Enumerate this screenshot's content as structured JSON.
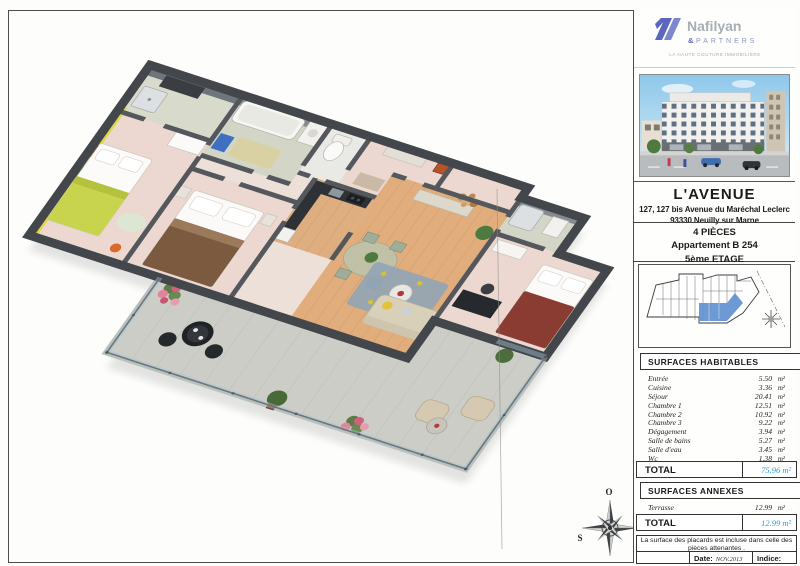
{
  "logo": {
    "brand": "Nafilyan",
    "amp": "&",
    "partners": "PARTNERS",
    "tagline": "LA HAUTE COUTURE IMMOBILIÈRE",
    "accent": "#5a66c0"
  },
  "project": {
    "title": "L'AVENUE",
    "address_line1": "127, 127 bis Avenue du Maréchal Leclerc",
    "address_line2": "93330 Neuilly sur Marne"
  },
  "unit": {
    "rooms_count": "4 PIÈCES",
    "apartment": "Appartement B 254",
    "floor": "5ème ETAGE"
  },
  "surfaces": {
    "habitables_title": "SURFACES  HABITABLES",
    "rows": [
      {
        "label": "Entrée",
        "value": "5.50",
        "unit": "m²"
      },
      {
        "label": "Cuisine",
        "value": "3.36",
        "unit": "m²"
      },
      {
        "label": "Séjour",
        "value": "20.41",
        "unit": "m²"
      },
      {
        "label": "Chambre 1",
        "value": "12.51",
        "unit": "m²"
      },
      {
        "label": "Chambre 2",
        "value": "10.92",
        "unit": "m²"
      },
      {
        "label": "Chambre 3",
        "value": "9.22",
        "unit": "m²"
      },
      {
        "label": "Dégagement",
        "value": "3.94",
        "unit": "m²"
      },
      {
        "label": "Salle de bains",
        "value": "5.27",
        "unit": "m²"
      },
      {
        "label": "Salle d'eau",
        "value": "3.45",
        "unit": "m²"
      },
      {
        "label": "Wc",
        "value": "1.38",
        "unit": "m²"
      }
    ],
    "total_label": "TOTAL",
    "total_value": "75.96 m²",
    "annexes_title": "SURFACES  ANNEXES",
    "annexes_rows": [
      {
        "label": "Terrasse",
        "value": "12.99",
        "unit": "m²"
      }
    ],
    "annexes_total_label": "TOTAL",
    "annexes_total_value": "12.99 m²",
    "total_color": "#2d9bd5"
  },
  "note": {
    "text": "La surface des placards est incluse dans celle des pièces attenantes ."
  },
  "footer": {
    "date_label": "Date:",
    "date_value": "NOV.2013",
    "indice_label": "Indice:"
  },
  "compass": {
    "top": "O",
    "right": "N",
    "left": "S",
    "bottom": "E"
  }
}
